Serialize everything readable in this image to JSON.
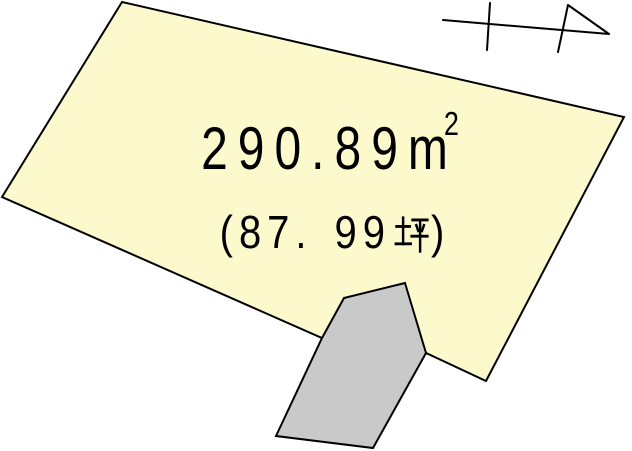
{
  "diagram": {
    "kind_label": "land-plot-plan",
    "background": "#ffffff",
    "outline_color": "#000000",
    "parcel": {
      "fill": "#fcf9cd",
      "points": "122,2 624,117 486,381 426,353 322,338 2,197",
      "area_m2_text": "290.89㎡",
      "area_m2_value": "290.89",
      "area_m2_unit_base": "m",
      "area_m2_unit_exponent": "2",
      "area_tsubo_text": "(87.99坪)",
      "tsubo_part_a": "(87.",
      "tsubo_part_b": "99",
      "tsubo_unit": "坪",
      "tsubo_close": ")"
    },
    "building": {
      "fill": "#c9c9c9",
      "points": "405,283 426,353 373,448 276,436 322,338 344,298"
    },
    "north_arrow": {
      "icon": "north-arrow-icon",
      "path": "M443,20 L609,34 M490,3 L487,50 M568,5 L609,34 M568,5 L558,52"
    }
  }
}
